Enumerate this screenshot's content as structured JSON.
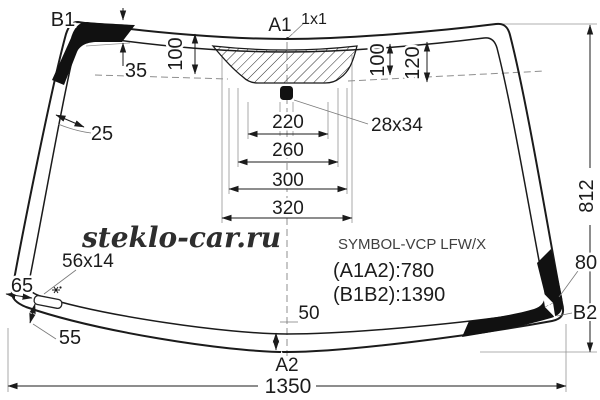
{
  "watermark": "steklo-car.ru",
  "part_info": {
    "model": "SYMBOL-VCP LFW/X",
    "dim_a": "(A1A2):780",
    "dim_b": "(B1B2):1390"
  },
  "markers": {
    "a1": "A1",
    "a2": "A2",
    "b1": "B1",
    "b2": "B2",
    "point": "1x1"
  },
  "dims": {
    "band_top": "35",
    "edge_left": "25",
    "depth_left": "100",
    "depth_right": "100",
    "depth_outer": "120",
    "mount": "28x34",
    "w220": "220",
    "w260": "260",
    "w300": "300",
    "w320": "320",
    "height": "812",
    "band_right": "80",
    "sticker": "56x14",
    "corner": "65",
    "left_gap": "55",
    "center_gap": "50",
    "width": "1350"
  },
  "colors": {
    "line": "#1b1b1b",
    "band": "#111111",
    "background": "#ffffff"
  }
}
